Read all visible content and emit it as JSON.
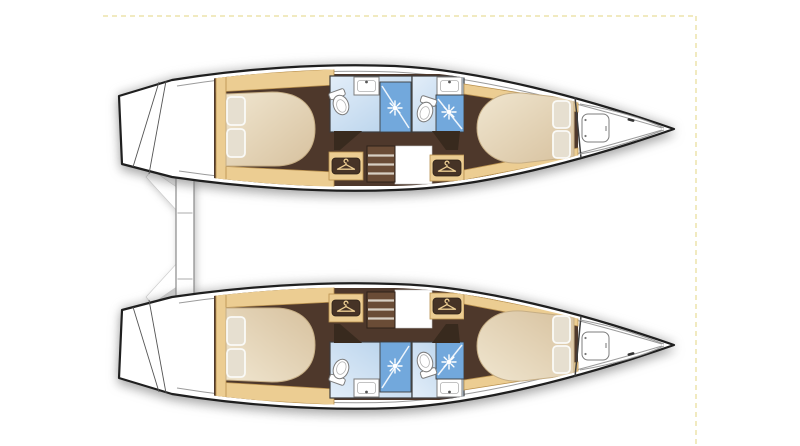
{
  "vessel": {
    "type": "Catamaran yacht accommodation floor plan, top-down view, bow pointing right",
    "view": "deck plan",
    "bow_direction": "right",
    "hulls": [
      {
        "name": "port hull (top)",
        "rooms": [
          "aft double cabin with berth and two pillows",
          "aft bathroom with toilet, sink and shower",
          "forward bathroom with toilet, sink and shower",
          "companionway steps",
          "aft wardrobe",
          "forward wardrobe",
          "forward double cabin with berth and two pillows",
          "foredeck with bow hatch"
        ]
      },
      {
        "name": "starboard hull (bottom)",
        "rooms": [
          "aft double cabin with berth and two pillows",
          "aft bathroom with toilet, sink and shower",
          "forward bathroom with toilet, sink and shower",
          "companionway steps",
          "aft wardrobe",
          "forward wardrobe",
          "forward double cabin with berth and two pillows",
          "foredeck with bow hatch"
        ]
      }
    ],
    "stern_features": [
      "transom steps on each hull",
      "central stern platform with segments"
    ],
    "counts": {
      "cabins": 4,
      "bathrooms": 4,
      "wardrobes": 4,
      "bow_hatches": 2
    }
  },
  "icons": {
    "wardrobe_hanger": "clothes-hanger badge",
    "shower_spray": "white sunburst spray head",
    "toilet": "oval toilet with cistern",
    "sink": "rectangular washbasin counter",
    "bow_hatch": "rounded-square deck hatch",
    "cleat": "small deck cleat"
  },
  "colors": {
    "background": "#ffffff",
    "page_border": "#f1eac0",
    "hull_outline": "#1f1f1f",
    "deck_line": "#9b9b9b",
    "wood_trim": "#eccd92",
    "wood_trim_edge": "#b8904e",
    "cabin_floor": "#4e382b",
    "wall_wedge": "#382a1e",
    "bed_light": "#f0e6d0",
    "bed_dark": "#d7c19e",
    "bed_edge": "#c6ae85",
    "pillow": "#e6dfd0",
    "pillow_edge": "#fafaf7",
    "bath_light": "#e3eef9",
    "bath_blue": "#b4d0ea",
    "shower_blue": "#72a8dc",
    "shower_glass": "#eef5fc",
    "fixture_fill": "#ffffff",
    "fixture_line": "#7d7d7d",
    "wall_line": "#3d3d3d",
    "steps_brown": "#6a4c36",
    "steps_gap": "#d8cfc3",
    "steps_edge": "#2f221a",
    "badge_brown": "#463326",
    "platform_line": "#8a8a8a"
  }
}
